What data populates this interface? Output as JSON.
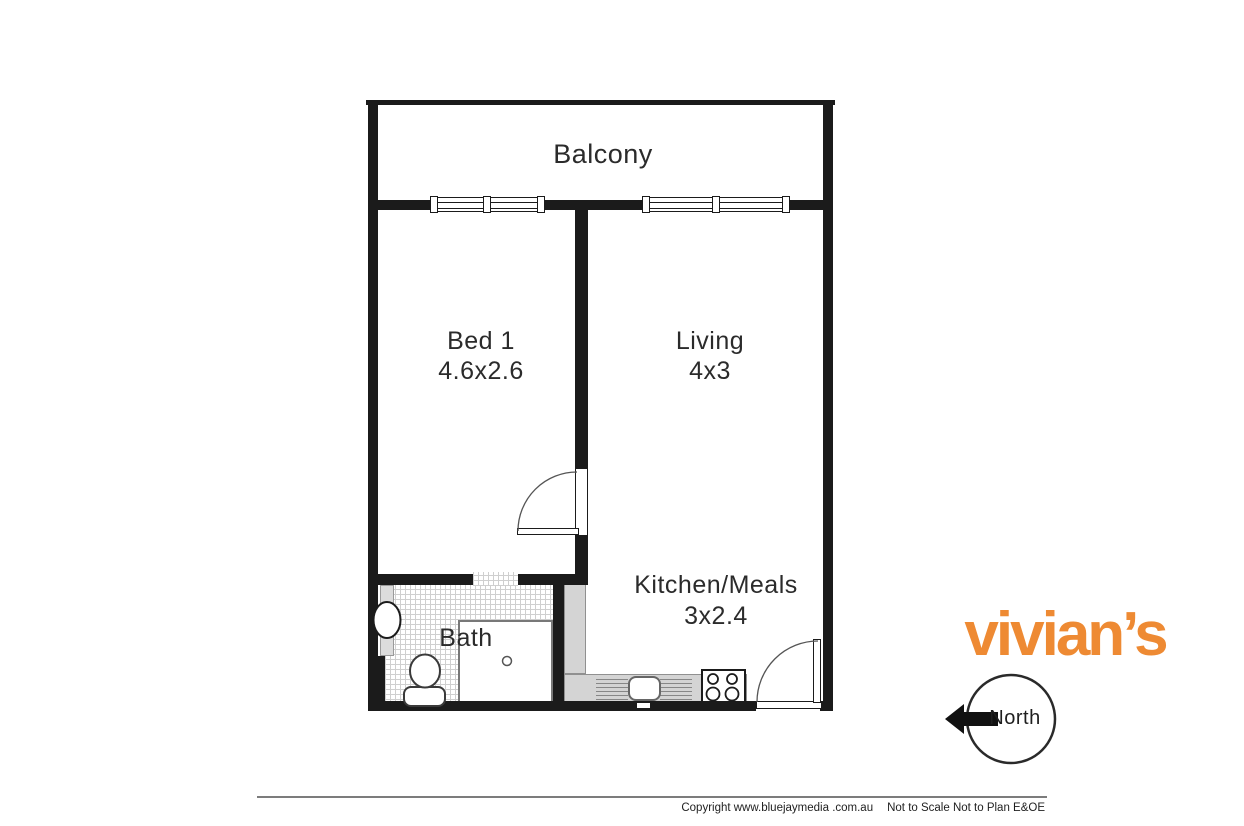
{
  "document": {
    "type": "apartment-floor-plan"
  },
  "rooms": {
    "balcony": {
      "name": "Balcony"
    },
    "bed1": {
      "name": "Bed 1",
      "dimensions": "4.6x2.6"
    },
    "living": {
      "name": "Living",
      "dimensions": "4x3"
    },
    "kitchen": {
      "name": "Kitchen/Meals",
      "dimensions": "3x2.4"
    },
    "bath": {
      "name": "Bath"
    }
  },
  "compass": {
    "label": "North",
    "direction": "left"
  },
  "branding": {
    "logo_text": "vivian’s",
    "logo_color": "#EE8A33"
  },
  "footer": {
    "copyright": "Copyright www.bluejaymedia .com.au",
    "disclaimer": "Not to Scale Not to Plan E&OE"
  },
  "colors": {
    "wall": "#1B1B1B",
    "counter_fill": "#D4D4D4",
    "tile_line": "#CFCFCF",
    "fixture_outline": "#3A3A3A",
    "logo_orange": "#EE8A33"
  }
}
